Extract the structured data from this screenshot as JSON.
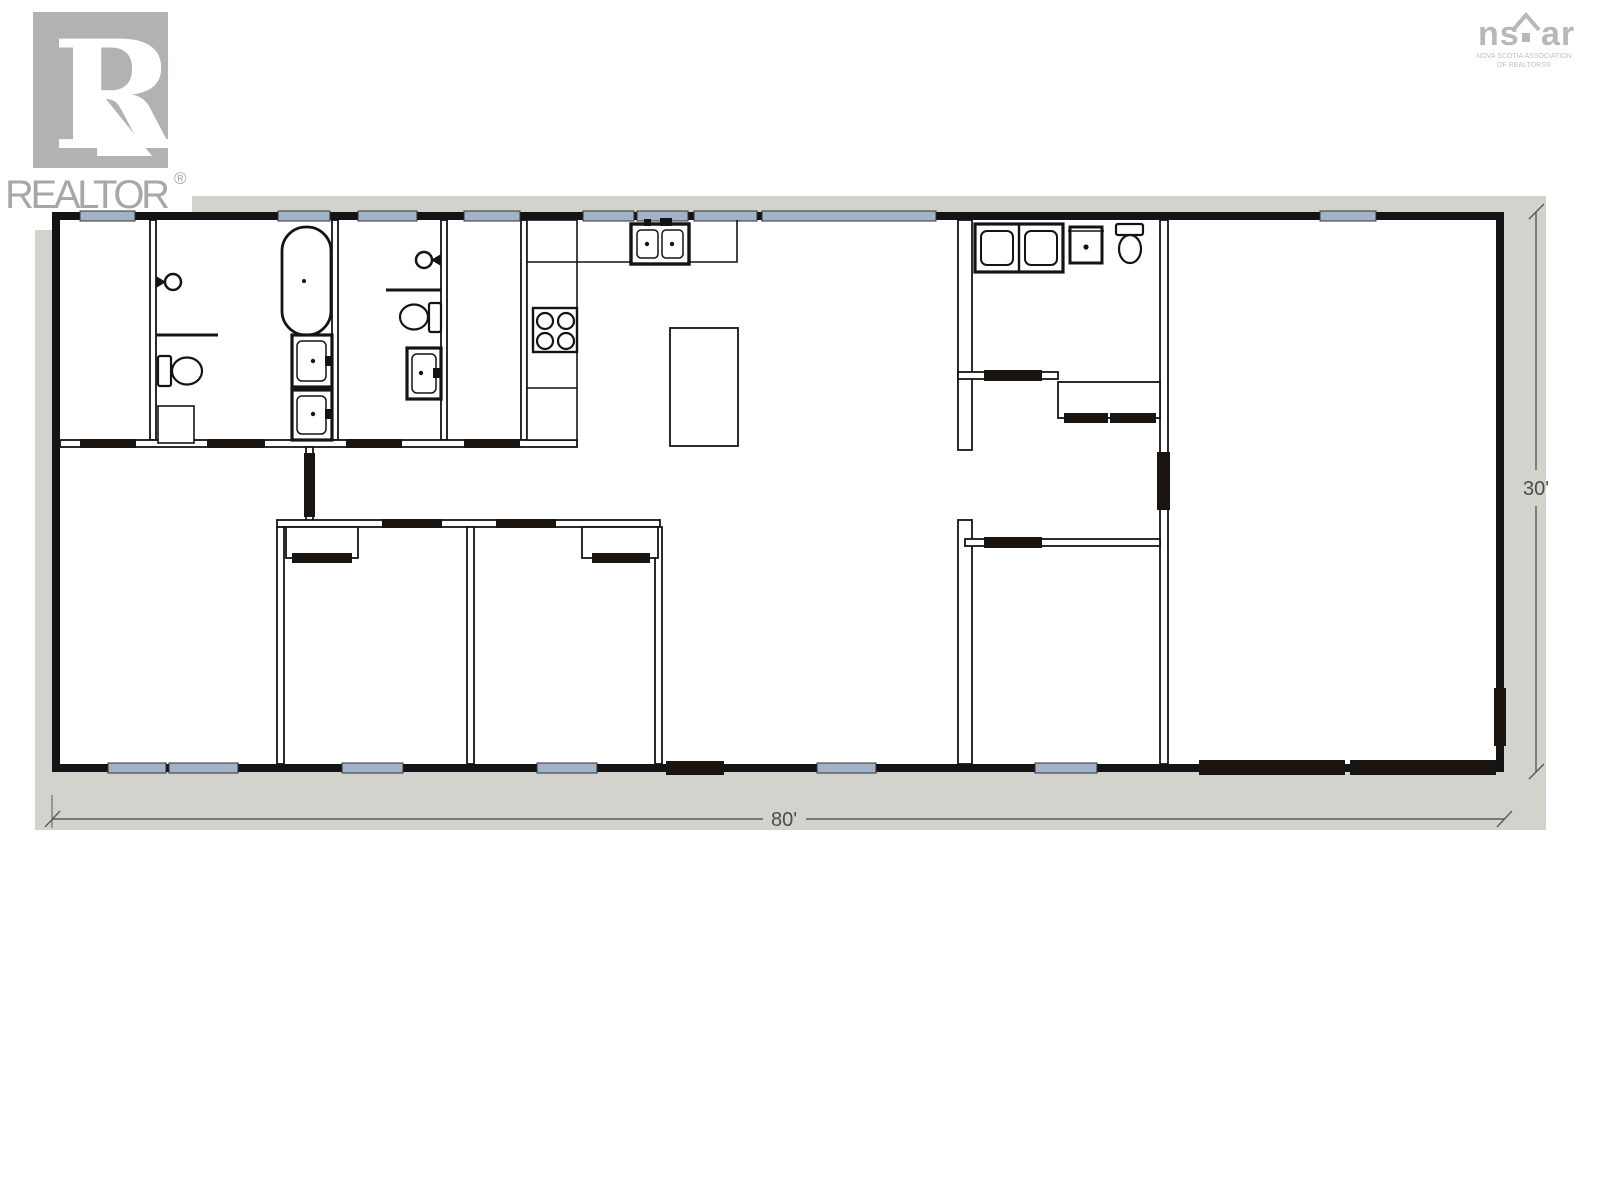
{
  "branding": {
    "realtor": {
      "letter": "R",
      "wordmark": "REALTOR",
      "registered": "®",
      "square_color": "#b3b1b1",
      "letter_color": "#ffffff",
      "wordmark_color": "#a9a6a6"
    },
    "nsar": {
      "left": "ns",
      "right": "ar",
      "sub_line1": "NOVA SCOTIA ASSOCIATION",
      "sub_line2": "OF REALTORS®",
      "color": "#b9b7b7"
    }
  },
  "dimensions": {
    "width_label": "80'",
    "height_label": "30'",
    "text_color": "#4c4c4c",
    "line_color": "#5a5a5a"
  },
  "floor_plan": {
    "type": "residential single-storey floor plan",
    "matte_color": "#d1d3cc",
    "wall_color": "#141414",
    "window_color": "#a2b3c8",
    "door_color": "#1b1512",
    "floor_color": "#ffffff",
    "fixture_icons": [
      "bathtub-icon",
      "shower-head-icon",
      "toilet-icon",
      "vanity-sink-icon",
      "double-kitchen-sink-icon",
      "stove-burners-icon",
      "kitchen-island-icon",
      "washer-icon",
      "dryer-icon",
      "laundry-sink-icon",
      "closet-doors-icon"
    ],
    "counts": {
      "top_wall_windows": 9,
      "bottom_wall_windows": 6,
      "garage_doors": 2,
      "bathtubs": 1,
      "toilets": 3,
      "vanity_sinks": 3
    }
  }
}
